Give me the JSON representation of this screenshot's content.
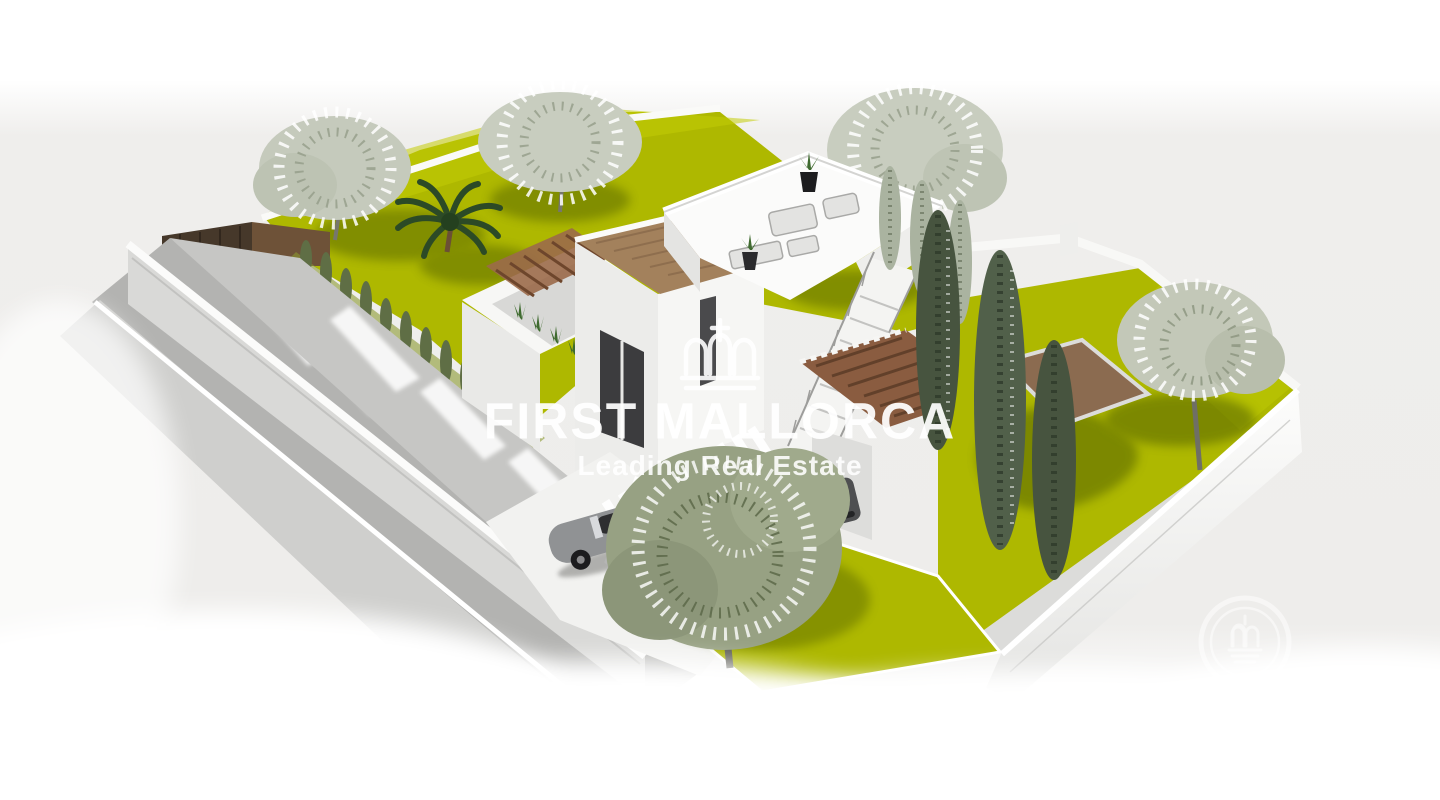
{
  "watermark": {
    "brand": "FIRST MALLORCA",
    "tagline": "Leading Real Estate",
    "text_color": "#ffffff",
    "crown_icon": "crown-icon",
    "seal_icon": "first-mallorca-seal-icon"
  },
  "scene": {
    "description_labels": {
      "subject": "aerial 3d rendering of modern villa with walled garden plot",
      "elements": [
        "perimeter-walls",
        "street",
        "lawns",
        "sketch-trees",
        "palm-tree",
        "cypress-trees",
        "villa",
        "roof-terrace",
        "external-staircase",
        "pergolas",
        "driveway-carport",
        "classic-convertible-car",
        "suv-car"
      ]
    },
    "colors": {
      "background_band": "#efeeec",
      "lawn": "#aeb800",
      "lawn_shadow": "#6e7d08",
      "wall_white": "#ffffff",
      "wall_shade": "#d5d5d3",
      "road": "#b3b3b1",
      "roof_deck_brown": "#a3815c",
      "pergola_brown": "#8a5c40",
      "gate_brown": "#46382a",
      "palm_green": "#2c4a26",
      "cypress_dark": "#47543f",
      "sketch_tree": "#c5cabc",
      "classic_car": "#909294",
      "suv_car": "#4e4f51"
    }
  }
}
